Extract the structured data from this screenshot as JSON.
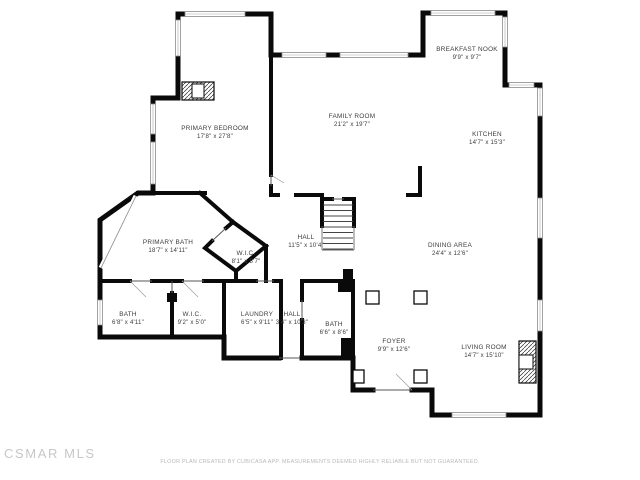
{
  "floor_plan": {
    "rooms": [
      {
        "name": "BREAKFAST NOOK",
        "dims": "9'9\" x 9'7\"",
        "x": 467,
        "y": 54
      },
      {
        "name": "FAMILY ROOM",
        "dims": "21'2\" x 19'7\"",
        "x": 352,
        "y": 121
      },
      {
        "name": "KITCHEN",
        "dims": "14'7\" x 15'3\"",
        "x": 487,
        "y": 139
      },
      {
        "name": "PRIMARY BEDROOM",
        "dims": "17'8\" x 27'8\"",
        "x": 215,
        "y": 133
      },
      {
        "name": "PRIMARY BATH",
        "dims": "18'7\" x 14'11\"",
        "x": 168,
        "y": 247
      },
      {
        "name": "W.I.C.",
        "dims": "8'1\" x 8'7\"",
        "x": 246,
        "y": 258
      },
      {
        "name": "HALL",
        "dims": "11'5\" x 10'4\"",
        "x": 306,
        "y": 242
      },
      {
        "name": "DINING AREA",
        "dims": "24'4\" x 12'6\"",
        "x": 450,
        "y": 250
      },
      {
        "name": "BATH",
        "dims": "6'8\" x 4'11\"",
        "x": 128,
        "y": 319
      },
      {
        "name": "W.I.C.",
        "dims": "9'2\" x 5'0\"",
        "x": 192,
        "y": 319
      },
      {
        "name": "LAUNDRY",
        "dims": "6'5\" x 9'11\"",
        "x": 257,
        "y": 319
      },
      {
        "name": "HALL",
        "dims": "3'4\" x 10'3\"",
        "x": 292,
        "y": 319
      },
      {
        "name": "BATH",
        "dims": "6'6\" x 8'6\"",
        "x": 334,
        "y": 329
      },
      {
        "name": "FOYER",
        "dims": "9'9\" x 12'6\"",
        "x": 394,
        "y": 346
      },
      {
        "name": "LIVING ROOM",
        "dims": "14'7\" x 15'10\"",
        "x": 484,
        "y": 352
      }
    ],
    "features": [
      "fireplace",
      "stairs",
      "columns",
      "windows",
      "entry-door"
    ],
    "colors": {
      "wall": "#0a0a0a",
      "window_line": "#8a8a8a",
      "label": "#3c3c3c"
    }
  },
  "watermark": "CSMAR MLS",
  "disclaimer": "FLOOR PLAN CREATED BY CUBICASA APP. MEASUREMENTS DEEMED HIGHLY RELIABLE BUT NOT GUARANTEED."
}
